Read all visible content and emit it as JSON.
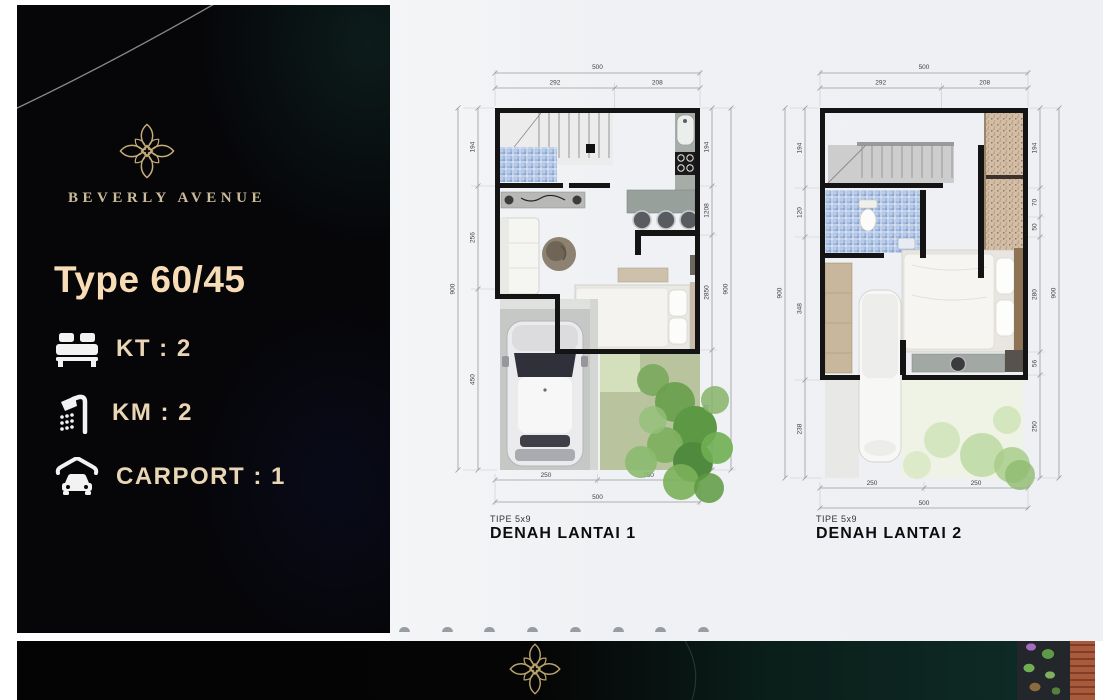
{
  "sidebar": {
    "brand": "BEVERLY AVENUE",
    "type_title": "Type 60/45",
    "specs": [
      {
        "icon": "bed-icon",
        "label": "KT : 2"
      },
      {
        "icon": "shower-icon",
        "label": "KM : 2"
      },
      {
        "icon": "carport-icon",
        "label": "CARPORT : 1"
      }
    ]
  },
  "plans": {
    "plan1": {
      "tipe_label": "TIPE 5x9",
      "caption": "DENAH LANTAI 1",
      "dims": {
        "top_total": "500",
        "top_segments": [
          "292",
          "208"
        ],
        "left_total": "900",
        "left_segments": [
          "194",
          "256",
          "450"
        ],
        "right_total": "900",
        "right_segments": [
          "194",
          "1208",
          "2850",
          "300"
        ],
        "bottom_segments": [
          "250",
          "250"
        ],
        "bottom_total": "500"
      }
    },
    "plan2": {
      "tipe_label": "TIPE 5x9",
      "caption": "DENAH LANTAI 2",
      "dims": {
        "top_total": "500",
        "top_segments": [
          "292",
          "208"
        ],
        "left_total": "900",
        "left_segments": [
          "194",
          "120",
          "348",
          "238"
        ],
        "right_total": "900",
        "right_segments": [
          "194",
          "70",
          "50",
          "280",
          "56",
          "250"
        ],
        "bottom_segments": [
          "250",
          "250"
        ],
        "bottom_total": "500"
      }
    }
  },
  "colors": {
    "gold": "#c5ad78",
    "cream_title": "#f8dcb6",
    "spec_text": "#e9d6b4",
    "sidebar_bg": "#060609",
    "footer_teal": "#0e2a24",
    "tile_blue": "#a9c0e2",
    "garden_green": "#6aa04e"
  }
}
